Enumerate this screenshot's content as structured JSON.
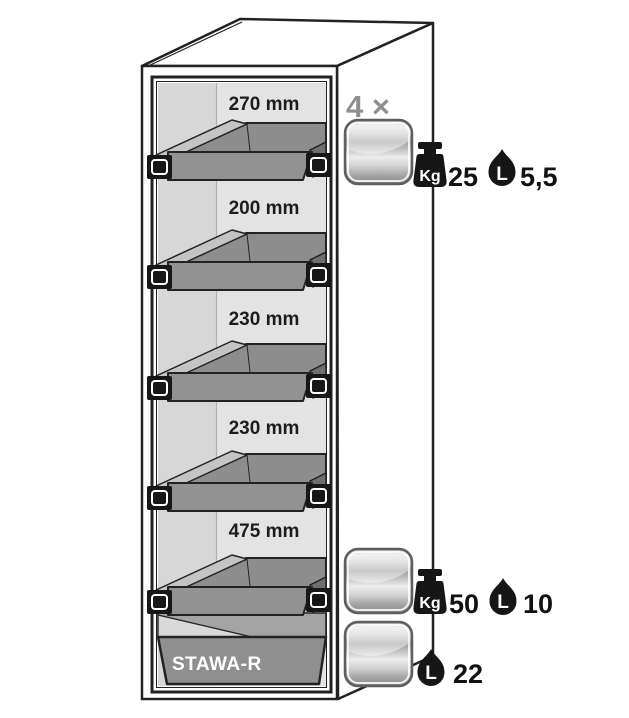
{
  "cabinet": {
    "sump_label": "STAWA-R",
    "sections": [
      {
        "label": "270 mm"
      },
      {
        "label": "200 mm"
      },
      {
        "label": "230 mm"
      },
      {
        "label": "230 mm"
      },
      {
        "label": "475 mm"
      }
    ]
  },
  "legend": {
    "drawer_count": "4 ×",
    "rows": [
      {
        "weight_unit": "Kg",
        "weight": "25",
        "volume_unit": "L",
        "volume": "5,5"
      },
      {
        "weight_unit": "Kg",
        "weight": "50",
        "volume_unit": "L",
        "volume": "10"
      },
      {
        "volume_unit": "L",
        "volume": "22"
      }
    ]
  },
  "icons": {
    "drawer_front": "metal-drawer-front-icon",
    "weight": "kg-weight-icon",
    "volume": "liter-drop-icon"
  },
  "colors": {
    "outline": "#222222",
    "drawer_gray": "#8d8d8d",
    "interior_light": "#e3e3e3",
    "interior_shade": "#d7d7d7",
    "metal_silver": "#c9c9c9",
    "quantity_gray": "#909090",
    "icon_black": "#161616"
  }
}
